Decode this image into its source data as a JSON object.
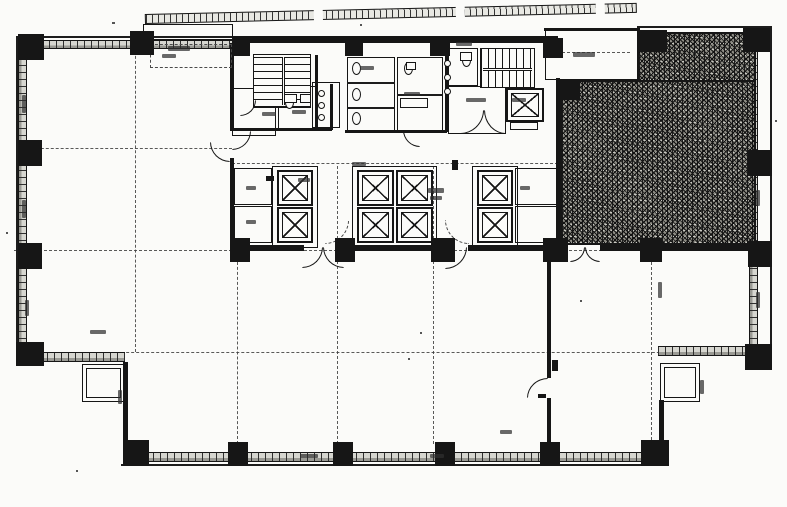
{
  "canvas": {
    "w": 787,
    "h": 507,
    "paper": "#fbfbf9",
    "ink": "#161616",
    "hatch_fill": "#8e8d85",
    "band_fill": "#d6d6d0"
  },
  "plan": {
    "columns": [
      [
        18,
        34,
        26,
        26
      ],
      [
        130,
        31,
        24,
        24
      ],
      [
        232,
        36,
        18,
        20
      ],
      [
        345,
        36,
        18,
        20
      ],
      [
        430,
        36,
        20,
        20
      ],
      [
        543,
        38,
        20,
        20
      ],
      [
        637,
        30,
        30,
        22
      ],
      [
        743,
        28,
        27,
        24
      ],
      [
        18,
        140,
        24,
        26
      ],
      [
        18,
        243,
        24,
        26
      ],
      [
        16,
        342,
        28,
        24
      ],
      [
        748,
        150,
        24,
        26
      ],
      [
        748,
        241,
        24,
        26
      ],
      [
        745,
        344,
        27,
        26
      ],
      [
        123,
        440,
        26,
        26
      ],
      [
        228,
        442,
        20,
        24
      ],
      [
        333,
        442,
        20,
        24
      ],
      [
        435,
        442,
        20,
        24
      ],
      [
        540,
        442,
        20,
        24
      ],
      [
        641,
        440,
        28,
        26
      ],
      [
        558,
        80,
        22,
        20
      ],
      [
        640,
        238,
        22,
        24
      ],
      [
        230,
        238,
        20,
        24
      ],
      [
        335,
        238,
        20,
        24
      ],
      [
        431,
        238,
        24,
        24
      ],
      [
        543,
        238,
        25,
        24
      ]
    ],
    "walls": [
      [
        232,
        36,
        326,
        7
      ],
      [
        230,
        43,
        4,
        88
      ],
      [
        230,
        158,
        4,
        82
      ],
      [
        556,
        78,
        4,
        167
      ],
      [
        544,
        28,
        96,
        3
      ],
      [
        230,
        245,
        74,
        6
      ],
      [
        344,
        245,
        103,
        6
      ],
      [
        468,
        245,
        100,
        6
      ],
      [
        600,
        245,
        156,
        6
      ],
      [
        547,
        251,
        4,
        127
      ],
      [
        547,
        398,
        4,
        46
      ],
      [
        123,
        362,
        5,
        80
      ],
      [
        659,
        400,
        5,
        44
      ],
      [
        315,
        55,
        3,
        76
      ],
      [
        330,
        84,
        3,
        46
      ],
      [
        230,
        128,
        102,
        3
      ],
      [
        345,
        130,
        102,
        3
      ],
      [
        445,
        48,
        3,
        84
      ]
    ],
    "hairlines": [
      [
        16,
        36,
        2,
        310
      ],
      [
        16,
        36,
        218,
        2
      ],
      [
        770,
        28,
        2,
        318
      ],
      [
        637,
        26,
        135,
        2
      ],
      [
        121,
        464,
        548,
        2
      ],
      [
        38,
        350,
        2,
        14
      ]
    ],
    "bands_h": [
      [
        42,
        40,
        90,
        9
      ],
      [
        152,
        40,
        80,
        9
      ],
      [
        125,
        452,
        540,
        10
      ],
      [
        40,
        352,
        85,
        10
      ],
      [
        658,
        346,
        90,
        10
      ]
    ],
    "bands_v": [
      [
        18,
        46,
        9,
        300
      ],
      [
        749,
        50,
        9,
        296
      ]
    ],
    "chains_h": [
      [
        26,
        148,
        232
      ],
      [
        232,
        163,
        558
      ],
      [
        14,
        250,
        772
      ],
      [
        26,
        352,
        770
      ],
      [
        552,
        52,
        630
      ]
    ],
    "chains_v": [
      [
        135,
        46,
        352
      ],
      [
        237,
        252,
        444
      ],
      [
        337,
        166,
        444
      ],
      [
        433,
        166,
        444
      ],
      [
        651,
        32,
        440
      ]
    ],
    "rooms": [
      [
        232,
        88,
        44,
        48
      ],
      [
        278,
        86,
        38,
        44
      ],
      [
        312,
        82,
        28,
        46
      ],
      [
        347,
        57,
        48,
        76
      ],
      [
        397,
        57,
        46,
        74
      ],
      [
        448,
        48,
        30,
        38
      ],
      [
        448,
        86,
        58,
        48
      ],
      [
        234,
        168,
        38,
        37
      ],
      [
        234,
        206,
        38,
        37
      ],
      [
        515,
        168,
        42,
        37
      ],
      [
        515,
        206,
        42,
        37
      ],
      [
        82,
        364,
        43,
        38
      ],
      [
        660,
        363,
        40,
        39
      ],
      [
        545,
        30,
        93,
        50
      ],
      [
        143,
        24,
        90,
        16
      ],
      [
        272,
        166,
        46,
        82
      ],
      [
        352,
        166,
        85,
        82
      ],
      [
        472,
        166,
        46,
        82
      ]
    ],
    "rooms_thin": [
      [
        86,
        368,
        35,
        30
      ],
      [
        664,
        367,
        32,
        31
      ]
    ],
    "rooms_dashed": [
      [
        150,
        44,
        82,
        24
      ]
    ],
    "stall_lines": [
      [
        347,
        82,
        48,
        1.5
      ],
      [
        347,
        107,
        48,
        1.5
      ],
      [
        397,
        94,
        46,
        1.5
      ]
    ],
    "stairs": [
      {
        "r": [
          253,
          54,
          58,
          54
        ],
        "dir": "treads-h",
        "rail": "rail-v"
      },
      {
        "r": [
          480,
          48,
          55,
          40
        ],
        "dir": "treads-v",
        "rail": "rail-h"
      }
    ],
    "elevators": [
      [
        277,
        170,
        36,
        36
      ],
      [
        277,
        207,
        36,
        36
      ],
      [
        357,
        170,
        37,
        36
      ],
      [
        396,
        170,
        37,
        36
      ],
      [
        357,
        207,
        37,
        36
      ],
      [
        396,
        207,
        37,
        36
      ],
      [
        477,
        170,
        36,
        36
      ],
      [
        477,
        207,
        36,
        36
      ],
      [
        506,
        88,
        38,
        34
      ]
    ],
    "doors": [
      {
        "r": [
          302,
          247,
          21,
          21
        ],
        "q": "br"
      },
      {
        "r": [
          323,
          247,
          21,
          21
        ],
        "q": "bl"
      },
      {
        "r": [
          445,
          247,
          22,
          22
        ],
        "q": "br"
      },
      {
        "r": [
          570,
          247,
          15,
          15
        ],
        "q": "br"
      },
      {
        "r": [
          585,
          247,
          15,
          15
        ],
        "q": "bl"
      },
      {
        "r": [
          527,
          378,
          21,
          20
        ],
        "q": "tl"
      },
      {
        "r": [
          232,
          131,
          19,
          19
        ],
        "q": "br"
      },
      {
        "r": [
          403,
          130,
          17,
          17
        ],
        "q": "bl"
      },
      {
        "r": [
          460,
          110,
          24,
          24
        ],
        "q": "br"
      },
      {
        "r": [
          484,
          110,
          22,
          24
        ],
        "q": "bl"
      },
      {
        "r": [
          325,
          220,
          24,
          24
        ],
        "q": "br",
        "dash": true
      },
      {
        "r": [
          445,
          220,
          24,
          24
        ],
        "q": "bl",
        "dash": true
      },
      {
        "r": [
          210,
          142,
          20,
          20
        ],
        "q": "bl"
      },
      {
        "r": [
          240,
          100,
          16,
          16
        ],
        "q": "br"
      }
    ],
    "toilets": [
      [
        352,
        62
      ],
      [
        352,
        88
      ],
      [
        352,
        112
      ],
      [
        404,
        62
      ],
      [
        285,
        96
      ],
      [
        462,
        54
      ]
    ],
    "circles": [
      [
        318,
        90
      ],
      [
        318,
        102
      ],
      [
        318,
        114
      ],
      [
        444,
        60
      ],
      [
        444,
        74
      ],
      [
        444,
        88
      ]
    ],
    "fixture_rects": [
      [
        284,
        94,
        13,
        9
      ],
      [
        300,
        94,
        11,
        9
      ],
      [
        400,
        98,
        28,
        10
      ],
      [
        406,
        62,
        10,
        8
      ],
      [
        510,
        122,
        28,
        8
      ],
      [
        460,
        52,
        12,
        9
      ]
    ],
    "fixture_solids": [
      [
        552,
        360,
        6,
        11
      ],
      [
        538,
        394,
        8,
        4
      ],
      [
        452,
        160,
        6,
        10
      ],
      [
        266,
        176,
        8,
        5
      ]
    ],
    "smudges": [
      [
        168,
        46,
        22,
        5
      ],
      [
        162,
        54,
        14,
        4
      ],
      [
        262,
        112,
        14,
        4
      ],
      [
        292,
        110,
        14,
        4
      ],
      [
        360,
        66,
        14,
        4
      ],
      [
        404,
        92,
        16,
        4
      ],
      [
        456,
        42,
        16,
        4
      ],
      [
        512,
        98,
        14,
        4
      ],
      [
        573,
        52,
        22,
        5
      ],
      [
        298,
        178,
        12,
        4
      ],
      [
        428,
        188,
        16,
        5
      ],
      [
        430,
        196,
        12,
        4
      ],
      [
        246,
        186,
        10,
        4
      ],
      [
        246,
        220,
        10,
        4
      ],
      [
        520,
        186,
        10,
        4
      ],
      [
        352,
        162,
        14,
        4
      ],
      [
        658,
        282,
        4,
        16
      ],
      [
        756,
        190,
        4,
        16
      ],
      [
        756,
        292,
        4,
        16
      ],
      [
        700,
        380,
        4,
        14
      ],
      [
        22,
        95,
        4,
        18
      ],
      [
        22,
        200,
        4,
        18
      ],
      [
        25,
        300,
        4,
        16
      ],
      [
        90,
        330,
        16,
        4
      ],
      [
        300,
        454,
        18,
        4
      ],
      [
        430,
        454,
        14,
        4
      ],
      [
        500,
        430,
        12,
        4
      ],
      [
        118,
        390,
        4,
        14
      ],
      [
        466,
        98,
        20,
        4
      ]
    ],
    "specks": [
      [
        6,
        232,
        2,
        2
      ],
      [
        420,
        332,
        2,
        2
      ],
      [
        700,
        66,
        2,
        2
      ],
      [
        112,
        22,
        3,
        2
      ],
      [
        580,
        300,
        2,
        2
      ],
      [
        76,
        470,
        2,
        2
      ],
      [
        360,
        24,
        2,
        2
      ],
      [
        775,
        120,
        2,
        2
      ],
      [
        408,
        358,
        2,
        2
      ]
    ],
    "hatch": [
      [
        560,
        80,
        196,
        165
      ],
      [
        637,
        32,
        119,
        50
      ]
    ],
    "balcony": {
      "x": 145,
      "y": 14,
      "w": 492,
      "h": 10,
      "angle": -1.3,
      "breaks": [
        168,
        310,
        450
      ]
    }
  }
}
